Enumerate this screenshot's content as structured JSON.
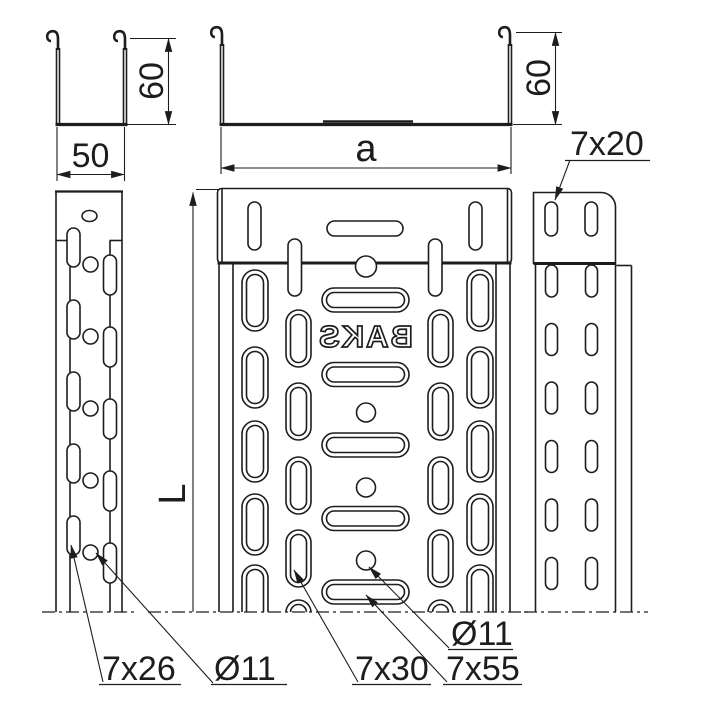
{
  "drawing": {
    "kind": "cable-tray technical drawing",
    "embossing": "BAKS",
    "colors": {
      "line": "#1d1d1d",
      "background": "#ffffff"
    },
    "dimensions": {
      "small_section_width": "50",
      "small_section_height": "60",
      "large_section_width": "a",
      "large_section_height": "60",
      "length": "L"
    },
    "annotations": {
      "slot_top_right": "7x20",
      "slot_side": "7x26",
      "hole_side": "Ø11",
      "slot_bottom": "7x30",
      "slot_bottom_long": "7x55",
      "hole_bottom": "Ø11"
    }
  }
}
